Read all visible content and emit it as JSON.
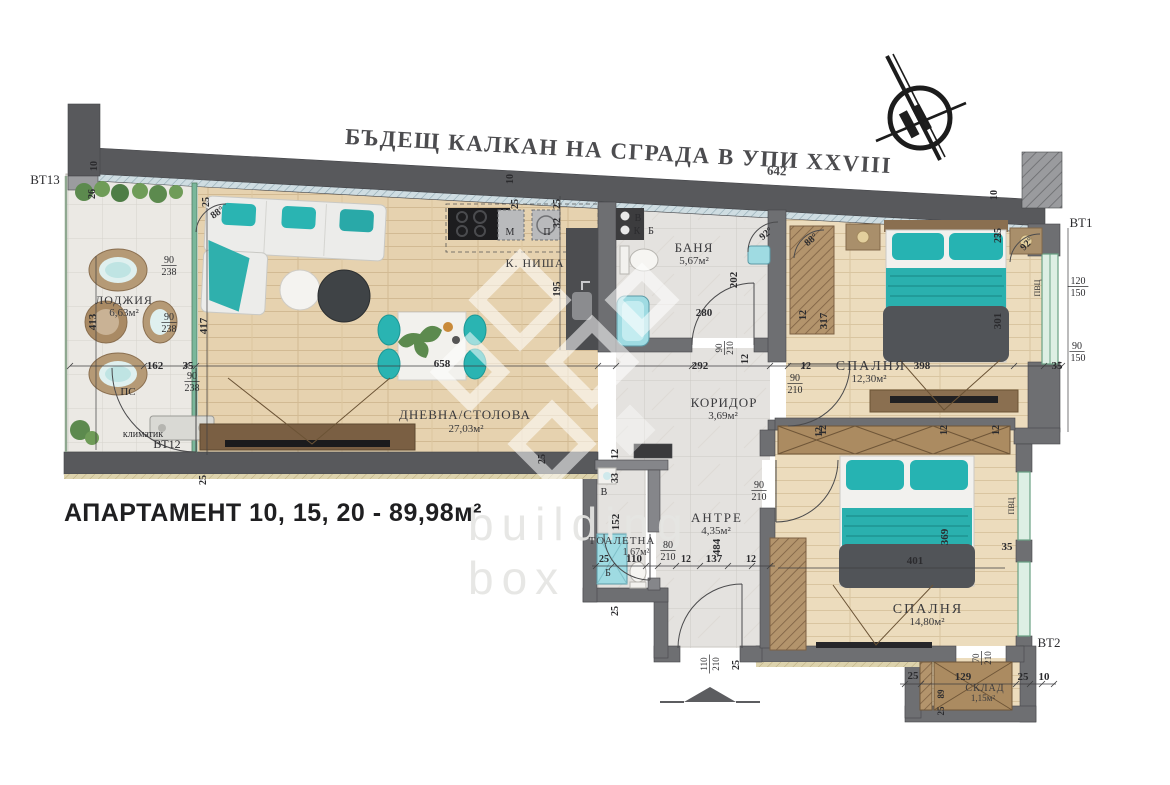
{
  "title": {
    "text": "БЪДЕЩ КАЛКАН НА СГРАДА В УПИ XXVIII",
    "subscript": "642"
  },
  "apartment_label": "АПАРТАМЕНТ 10, 15, 20 - 89,98м²",
  "watermark": {
    "line1": "building",
    "line2": "box"
  },
  "colors": {
    "teal_furniture": "#2ab4b2",
    "wall_dark": "#58595c",
    "wall_inner": "#6e6f72",
    "wood_floor": "#e6d2af",
    "tile_floor": "#ebe9e4",
    "stone_floor": "#e4e2df",
    "wardrobe_tan": "#ab8b61",
    "dark_blanket": "#515458"
  },
  "rooms": [
    {
      "id": "loggia",
      "name": "ЛОДЖИЯ",
      "area": "6,63м²"
    },
    {
      "id": "living",
      "name": "ДНЕВНА/СТОЛОВА",
      "area": "27,03м²"
    },
    {
      "id": "kitchen",
      "name": "К. НИША",
      "area": ""
    },
    {
      "id": "bath",
      "name": "БАНЯ",
      "area": "5,67м²"
    },
    {
      "id": "corridor",
      "name": "КОРИДОР",
      "area": "3,69м²"
    },
    {
      "id": "bedroom1",
      "name": "СПАЛНЯ",
      "area": "12,30м²"
    },
    {
      "id": "antre",
      "name": "АНТРЕ",
      "area": "4,35м²"
    },
    {
      "id": "toilet",
      "name": "ТОАЛЕТНА",
      "area": "1,67м²"
    },
    {
      "id": "bedroom2",
      "name": "СПАЛНЯ",
      "area": "14,80м²"
    },
    {
      "id": "storage",
      "name": "СКЛАД",
      "area": "1,15м²"
    }
  ],
  "dimensions": [
    {
      "t": "ВТ13",
      "x": 45,
      "y": 184,
      "s": 13,
      "w": "n"
    },
    {
      "t": "10",
      "x": 97,
      "y": 166,
      "r": -90,
      "s": 10
    },
    {
      "t": "26",
      "x": 95,
      "y": 194,
      "r": -90,
      "s": 10
    },
    {
      "t": "25",
      "x": 209,
      "y": 202,
      "r": -90,
      "s": 10
    },
    {
      "t": "88°",
      "x": 219,
      "y": 215,
      "s": 10,
      "r": -35
    },
    {
      "t": "10",
      "x": 513,
      "y": 179,
      "r": -90,
      "s": 10
    },
    {
      "t": "25",
      "x": 518,
      "y": 204,
      "r": -90,
      "s": 10
    },
    {
      "t": "10",
      "x": 997,
      "y": 195,
      "r": -90,
      "s": 10
    },
    {
      "t": "25",
      "x": 1001,
      "y": 233,
      "r": -90,
      "s": 10
    },
    {
      "t": "90",
      "x": 169,
      "y": 263,
      "s": 10,
      "w": "n",
      "u": 1
    },
    {
      "t": "238",
      "x": 169,
      "y": 275,
      "s": 10,
      "w": "n"
    },
    {
      "t": "413",
      "x": 96,
      "y": 322,
      "r": -90,
      "s": 11
    },
    {
      "t": "90",
      "x": 169,
      "y": 320,
      "s": 10,
      "w": "n",
      "u": 1
    },
    {
      "t": "238",
      "x": 169,
      "y": 332,
      "s": 10,
      "w": "n"
    },
    {
      "t": "417",
      "x": 207,
      "y": 326,
      "r": -90,
      "s": 11
    },
    {
      "t": "162",
      "x": 155,
      "y": 369,
      "s": 11
    },
    {
      "t": "35",
      "x": 188,
      "y": 369,
      "s": 11
    },
    {
      "t": "90",
      "x": 192,
      "y": 379,
      "s": 10,
      "w": "n",
      "u": 1
    },
    {
      "t": "238",
      "x": 192,
      "y": 391,
      "s": 10,
      "w": "n"
    },
    {
      "t": "ПС",
      "x": 128,
      "y": 395,
      "s": 11,
      "w": "n"
    },
    {
      "t": "климатик",
      "x": 143,
      "y": 437,
      "s": 10,
      "w": "n"
    },
    {
      "t": "ВТ12",
      "x": 167,
      "y": 448,
      "s": 12,
      "w": "n"
    },
    {
      "t": "25",
      "x": 206,
      "y": 480,
      "r": -90,
      "s": 10
    },
    {
      "t": "658",
      "x": 442,
      "y": 367,
      "s": 11
    },
    {
      "t": "25",
      "x": 545,
      "y": 459,
      "r": -90,
      "s": 10
    },
    {
      "t": "М",
      "x": 510,
      "y": 235,
      "s": 10,
      "w": "n"
    },
    {
      "t": "П",
      "x": 547,
      "y": 235,
      "s": 10,
      "w": "n"
    },
    {
      "t": "32",
      "x": 560,
      "y": 223,
      "r": -90,
      "s": 10
    },
    {
      "t": "25",
      "x": 560,
      "y": 204,
      "r": -90,
      "s": 10
    },
    {
      "t": "195",
      "x": 560,
      "y": 289,
      "r": -90,
      "s": 10
    },
    {
      "t": "В",
      "x": 638,
      "y": 221,
      "s": 10,
      "w": "n"
    },
    {
      "t": "К",
      "x": 637,
      "y": 234,
      "s": 10,
      "w": "n"
    },
    {
      "t": "Б",
      "x": 651,
      "y": 234,
      "s": 10,
      "w": "n"
    },
    {
      "t": "92°",
      "x": 768,
      "y": 236,
      "s": 10,
      "r": -40
    },
    {
      "t": "202",
      "x": 737,
      "y": 280,
      "r": -90,
      "s": 11
    },
    {
      "t": "280",
      "x": 704,
      "y": 316,
      "s": 11
    },
    {
      "t": "90",
      "x": 722,
      "y": 348,
      "r": -90,
      "s": 9,
      "w": "n",
      "u": 1
    },
    {
      "t": "210",
      "x": 733,
      "y": 348,
      "r": -90,
      "s": 9,
      "w": "n"
    },
    {
      "t": "12",
      "x": 748,
      "y": 359,
      "r": -90,
      "s": 10
    },
    {
      "t": "292",
      "x": 700,
      "y": 369,
      "s": 11
    },
    {
      "t": "12",
      "x": 806,
      "y": 369,
      "s": 10
    },
    {
      "t": "90",
      "x": 795,
      "y": 381,
      "s": 10,
      "w": "n",
      "u": 1
    },
    {
      "t": "210",
      "x": 795,
      "y": 393,
      "s": 10,
      "w": "n"
    },
    {
      "t": "12",
      "x": 826,
      "y": 430,
      "r": -90,
      "s": 10
    },
    {
      "t": "398",
      "x": 922,
      "y": 369,
      "s": 11
    },
    {
      "t": "301",
      "x": 1001,
      "y": 321,
      "r": -90,
      "s": 11
    },
    {
      "t": "317",
      "x": 827,
      "y": 321,
      "r": -90,
      "s": 11
    },
    {
      "t": "12",
      "x": 806,
      "y": 315,
      "r": -90,
      "s": 10
    },
    {
      "t": "25",
      "x": 1001,
      "y": 238,
      "r": -90,
      "s": 10
    },
    {
      "t": "88°",
      "x": 813,
      "y": 242,
      "s": 10,
      "r": -40
    },
    {
      "t": "92°",
      "x": 1029,
      "y": 246,
      "s": 10,
      "r": -45
    },
    {
      "t": "35",
      "x": 1057,
      "y": 369,
      "s": 11
    },
    {
      "t": "ПВЦ",
      "x": 1040,
      "y": 288,
      "r": -90,
      "s": 8,
      "w": "n"
    },
    {
      "t": "ВТ1",
      "x": 1081,
      "y": 227,
      "s": 13,
      "w": "n"
    },
    {
      "t": "120",
      "x": 1078,
      "y": 284,
      "s": 10,
      "w": "n",
      "u": 1
    },
    {
      "t": "150",
      "x": 1078,
      "y": 296,
      "s": 10,
      "w": "n"
    },
    {
      "t": "90",
      "x": 1077,
      "y": 349,
      "s": 10,
      "w": "n",
      "u": 1
    },
    {
      "t": "150",
      "x": 1078,
      "y": 361,
      "s": 10,
      "w": "n"
    },
    {
      "t": "12",
      "x": 822,
      "y": 432,
      "r": -90,
      "s": 10
    },
    {
      "t": "12",
      "x": 947,
      "y": 430,
      "r": -90,
      "s": 10
    },
    {
      "t": "12",
      "x": 999,
      "y": 430,
      "r": -90,
      "s": 10
    },
    {
      "t": "401",
      "x": 915,
      "y": 564,
      "s": 11
    },
    {
      "t": "369",
      "x": 948,
      "y": 537,
      "r": -90,
      "s": 11
    },
    {
      "t": "35",
      "x": 1007,
      "y": 550,
      "s": 11
    },
    {
      "t": "ПВЦ",
      "x": 1014,
      "y": 506,
      "r": -90,
      "s": 8,
      "w": "n"
    },
    {
      "t": "70",
      "x": 979,
      "y": 658,
      "r": -90,
      "s": 9,
      "w": "n",
      "u": 1
    },
    {
      "t": "210",
      "x": 991,
      "y": 658,
      "r": -90,
      "s": 9,
      "w": "n"
    },
    {
      "t": "129",
      "x": 963,
      "y": 680,
      "s": 11
    },
    {
      "t": "25",
      "x": 913,
      "y": 679,
      "s": 11
    },
    {
      "t": "25",
      "x": 1023,
      "y": 680,
      "s": 11
    },
    {
      "t": "10",
      "x": 1044,
      "y": 680,
      "s": 11
    },
    {
      "t": "ВТ2",
      "x": 1049,
      "y": 647,
      "s": 13,
      "w": "n"
    },
    {
      "t": "89",
      "x": 944,
      "y": 694,
      "r": -90,
      "s": 9
    },
    {
      "t": "25",
      "x": 944,
      "y": 711,
      "r": -90,
      "s": 9
    },
    {
      "t": "12",
      "x": 618,
      "y": 454,
      "r": -90,
      "s": 10
    },
    {
      "t": "33",
      "x": 618,
      "y": 478,
      "r": -90,
      "s": 10
    },
    {
      "t": "В",
      "x": 604,
      "y": 495,
      "s": 10,
      "w": "n"
    },
    {
      "t": "152",
      "x": 619,
      "y": 522,
      "r": -90,
      "s": 11
    },
    {
      "t": "484",
      "x": 720,
      "y": 547,
      "r": -90,
      "s": 11
    },
    {
      "t": "25",
      "x": 604,
      "y": 562,
      "s": 10
    },
    {
      "t": "110",
      "x": 634,
      "y": 562,
      "s": 11
    },
    {
      "t": "80",
      "x": 668,
      "y": 548,
      "s": 10,
      "w": "n",
      "u": 1
    },
    {
      "t": "210",
      "x": 668,
      "y": 560,
      "s": 10,
      "w": "n"
    },
    {
      "t": "12",
      "x": 686,
      "y": 562,
      "s": 10
    },
    {
      "t": "137",
      "x": 714,
      "y": 562,
      "s": 11
    },
    {
      "t": "12",
      "x": 751,
      "y": 562,
      "s": 10
    },
    {
      "t": "90",
      "x": 759,
      "y": 488,
      "s": 10,
      "w": "n",
      "u": 1
    },
    {
      "t": "210",
      "x": 759,
      "y": 500,
      "s": 10,
      "w": "n"
    },
    {
      "t": "Б",
      "x": 608,
      "y": 576,
      "s": 10,
      "w": "n"
    },
    {
      "t": "25",
      "x": 618,
      "y": 611,
      "r": -90,
      "s": 10
    },
    {
      "t": "110",
      "x": 707,
      "y": 664,
      "r": -90,
      "s": 9,
      "w": "n",
      "u": 1
    },
    {
      "t": "210",
      "x": 719,
      "y": 664,
      "r": -90,
      "s": 9,
      "w": "n"
    },
    {
      "t": "25",
      "x": 739,
      "y": 665,
      "r": -90,
      "s": 10
    }
  ]
}
